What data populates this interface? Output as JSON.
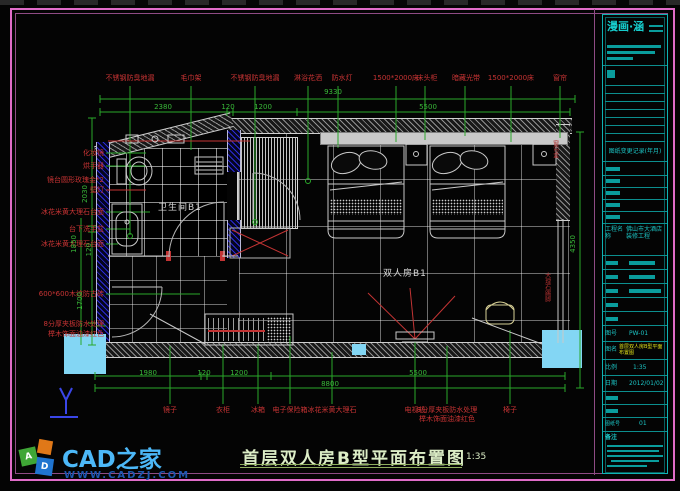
{
  "top_labels": [
    "不锈钢防臭地漏",
    "毛巾架",
    "不锈钢防臭地漏",
    "淋浴花洒",
    "防水灯",
    "1500*2000床",
    "床头柜",
    "暗藏光带",
    "1500*2000床",
    "窗帘"
  ],
  "left_labels": [
    "化妆镜",
    "烘手器",
    "镜台圆形玫瑰金*2",
    "壁灯",
    "冰花米黄大理石台面",
    "台下洗手盆",
    "冰花米黄大理石台面",
    "600*600木纹防古砖",
    "8分厚夹板防水处理",
    "榉木饰面油漆红色"
  ],
  "bottom_labels": [
    "镜子",
    "衣柜",
    "冰箱",
    "电子保险箱",
    "冰花米黄大理石",
    "电视机",
    "8分厚夹板防水处理",
    "榉木饰面油漆红色",
    "椅子"
  ],
  "right_labels": [
    "窗帘盒",
    "大理石踢脚"
  ],
  "dims": {
    "top_overall": "9330",
    "top_d1": "2380",
    "top_d2": "120",
    "top_d3": "1200",
    "top_d4": "5500",
    "left_d1": "2030",
    "left_d2": "1850",
    "left_d3": "120",
    "left_d4": "1700",
    "right_d1": "4350",
    "bottom_d1": "1980",
    "bottom_d2": "120",
    "bottom_d3": "1200",
    "bottom_d4": "5500",
    "bottom_overall": "8800"
  },
  "rooms": {
    "bathroom": "卫生间B1",
    "bedroom": "双人房B1"
  },
  "plan_title": {
    "text": "首层双人房B型平面布置图",
    "scale": "1:35"
  },
  "ucs": "Y",
  "brand": {
    "name": "CAD之家",
    "url": "WWW.CADZJ.COM",
    "a": "A",
    "d": "D"
  },
  "titleblock": {
    "logo": "漫画·涵",
    "revision_header": "图纸变更记录(年月)",
    "project_label": "工程名称",
    "project_value": "佛山市大酒店装修工程",
    "no_label": "图号",
    "no_value": "PW-01",
    "name_label": "图名",
    "name_value": "首层双人房B型平面布置图",
    "scale_label": "比例",
    "scale_value": "1:35",
    "date_label": "日期",
    "date_value": "2012/01/02",
    "sheet_label": "图纸号",
    "sheet_value": "01",
    "notes_label": "备注"
  }
}
